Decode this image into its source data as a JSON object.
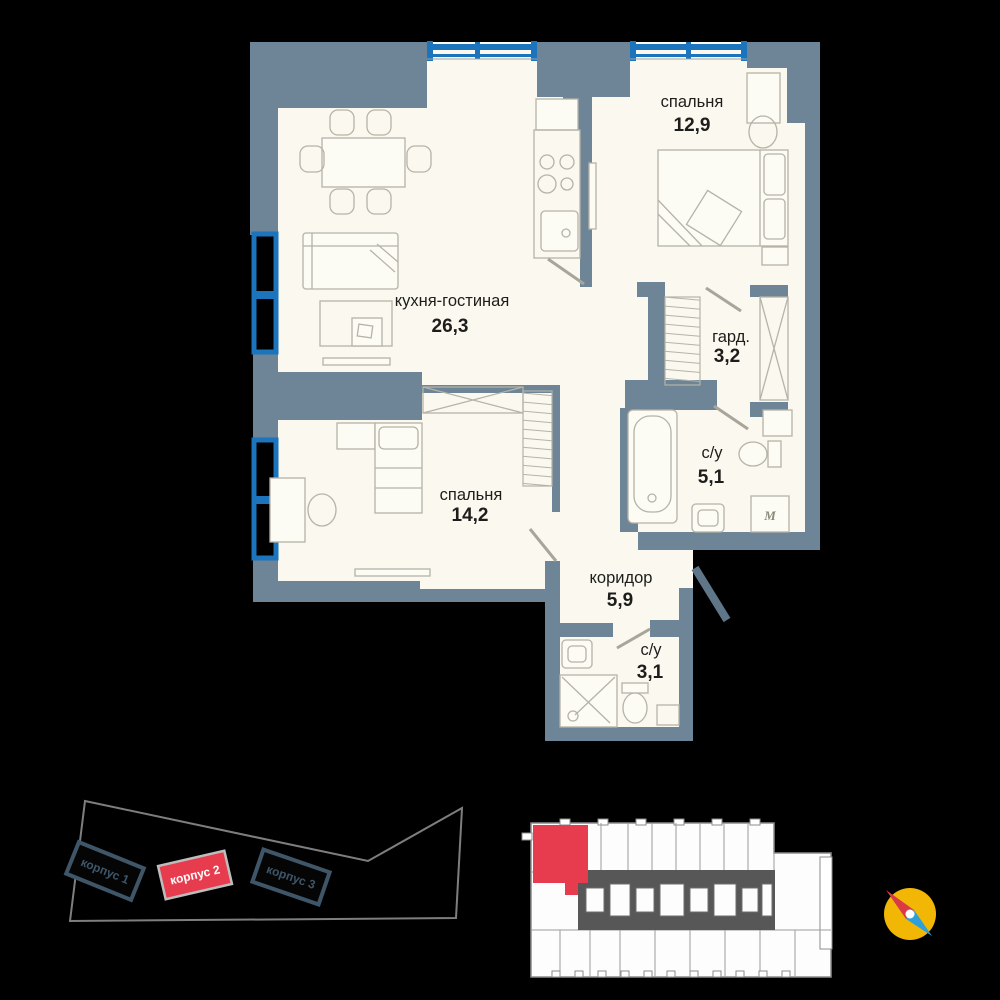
{
  "floor_plan": {
    "rooms": [
      {
        "id": "bedroom-1",
        "name": "спальня",
        "area": "12,9"
      },
      {
        "id": "kitchen-living",
        "name": "кухня-гостиная",
        "area": "26,3"
      },
      {
        "id": "wardrobe",
        "name": "гард.",
        "area": "3,2"
      },
      {
        "id": "bathroom-1",
        "name": "с/у",
        "area": "5,1"
      },
      {
        "id": "bedroom-2",
        "name": "спальня",
        "area": "14,2"
      },
      {
        "id": "corridor",
        "name": "коридор",
        "area": "5,9"
      },
      {
        "id": "bathroom-2",
        "name": "с/у",
        "area": "3,1"
      }
    ],
    "washer_symbol": "M"
  },
  "site_plan": {
    "buildings": [
      {
        "label": "корпус 1",
        "highlighted": false
      },
      {
        "label": "корпус 2",
        "highlighted": true
      },
      {
        "label": "корпус 3",
        "highlighted": false
      }
    ]
  },
  "floor_overview": {
    "selected_unit": "highlighted-apartment"
  },
  "colors": {
    "wall": "#6d8596",
    "floor": "#faf8ef",
    "window": "#1b74bc",
    "accent_red": "#e73c4e",
    "compass_yellow": "#f2b705",
    "compass_needle_red": "#d93a45",
    "compass_needle_blue": "#2f9fd8"
  }
}
